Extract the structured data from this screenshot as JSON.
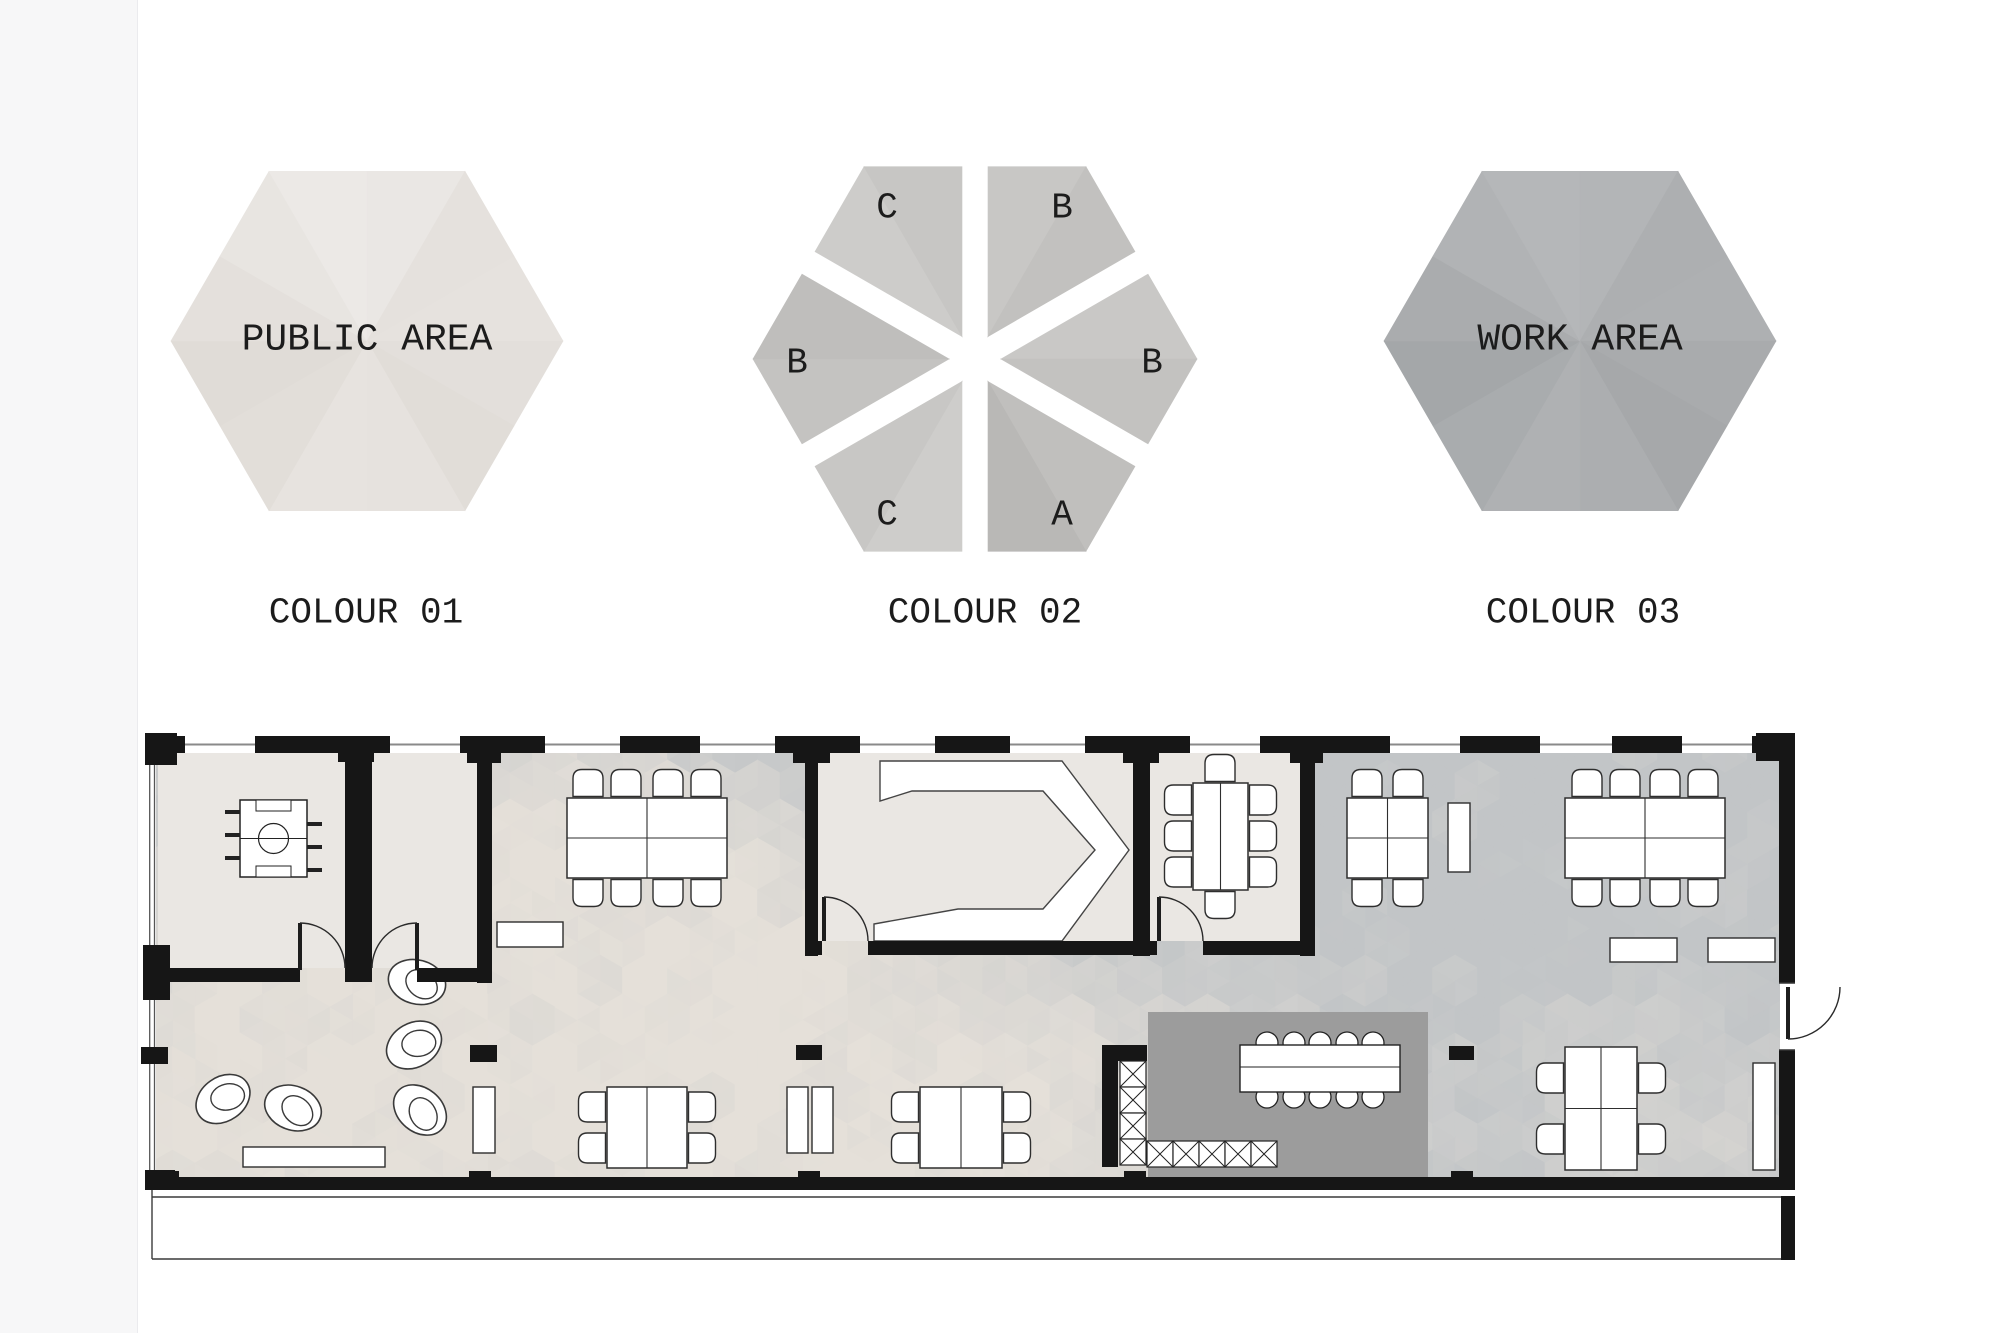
{
  "legend": {
    "items": [
      {
        "id": "colour-01",
        "caption": "COLOUR 01",
        "area_label": "PUBLIC AREA",
        "facets": [
          "#e6e2de",
          "#e3dfdb",
          "#e1ddd8",
          "#e6e2de",
          "#e7e3df",
          "#e2ded9",
          "#e0dcd7",
          "#e4e0dc",
          "#e8e5e1",
          "#ece9e6",
          "#eae7e4",
          "#e5e1dd"
        ]
      },
      {
        "id": "colour-02",
        "caption": "COLOUR 02",
        "area_label": "",
        "segments": [
          {
            "position": "top-left",
            "letter": "C"
          },
          {
            "position": "top-right",
            "letter": "B"
          },
          {
            "position": "left",
            "letter": "B"
          },
          {
            "position": "right",
            "letter": "B"
          },
          {
            "position": "bottom-left",
            "letter": "C"
          },
          {
            "position": "bottom-right",
            "letter": "A"
          }
        ],
        "facets": [
          "#c9c8c6",
          "#c3c2c0",
          "#c0bfbd",
          "#b9b8b6",
          "#cecdcb",
          "#c8c7c5",
          "#c4c3c1",
          "#bfbebc",
          "#cdccca",
          "#c7c6c4",
          "#c8c7c5",
          "#c2c1bf"
        ]
      },
      {
        "id": "colour-03",
        "caption": "COLOUR 03",
        "area_label": "WORK AREA",
        "facets": [
          "#aeb0b2",
          "#a9abad",
          "#a6a8aa",
          "#acaeb0",
          "#afb1b3",
          "#a9acae",
          "#a4a7a9",
          "#aaacae",
          "#b1b3b5",
          "#b5b7b9",
          "#b3b5b7",
          "#adafb1"
        ]
      }
    ]
  },
  "plan": {
    "colors": {
      "wall": "#161616",
      "room_floor": "#eae7e3",
      "kitchen_floor": "#9c9c9c",
      "mosaic_gray": "#c2c5c7",
      "mosaic_beige": "#e5e0d9",
      "furniture_fill": "#ffffff",
      "furniture_stroke": "#2e2e2e",
      "window_line": "#8a8a8a"
    },
    "features": [
      "foosball-table",
      "pod-chairs-lounge",
      "angled-presentation-counter",
      "meeting-tables-with-chairs",
      "kitchen-counter-hatched",
      "kitchen-table-round-chairs",
      "sideboards",
      "standing-desks",
      "terrace-strip",
      "hexagon-mosaic-floor"
    ]
  }
}
